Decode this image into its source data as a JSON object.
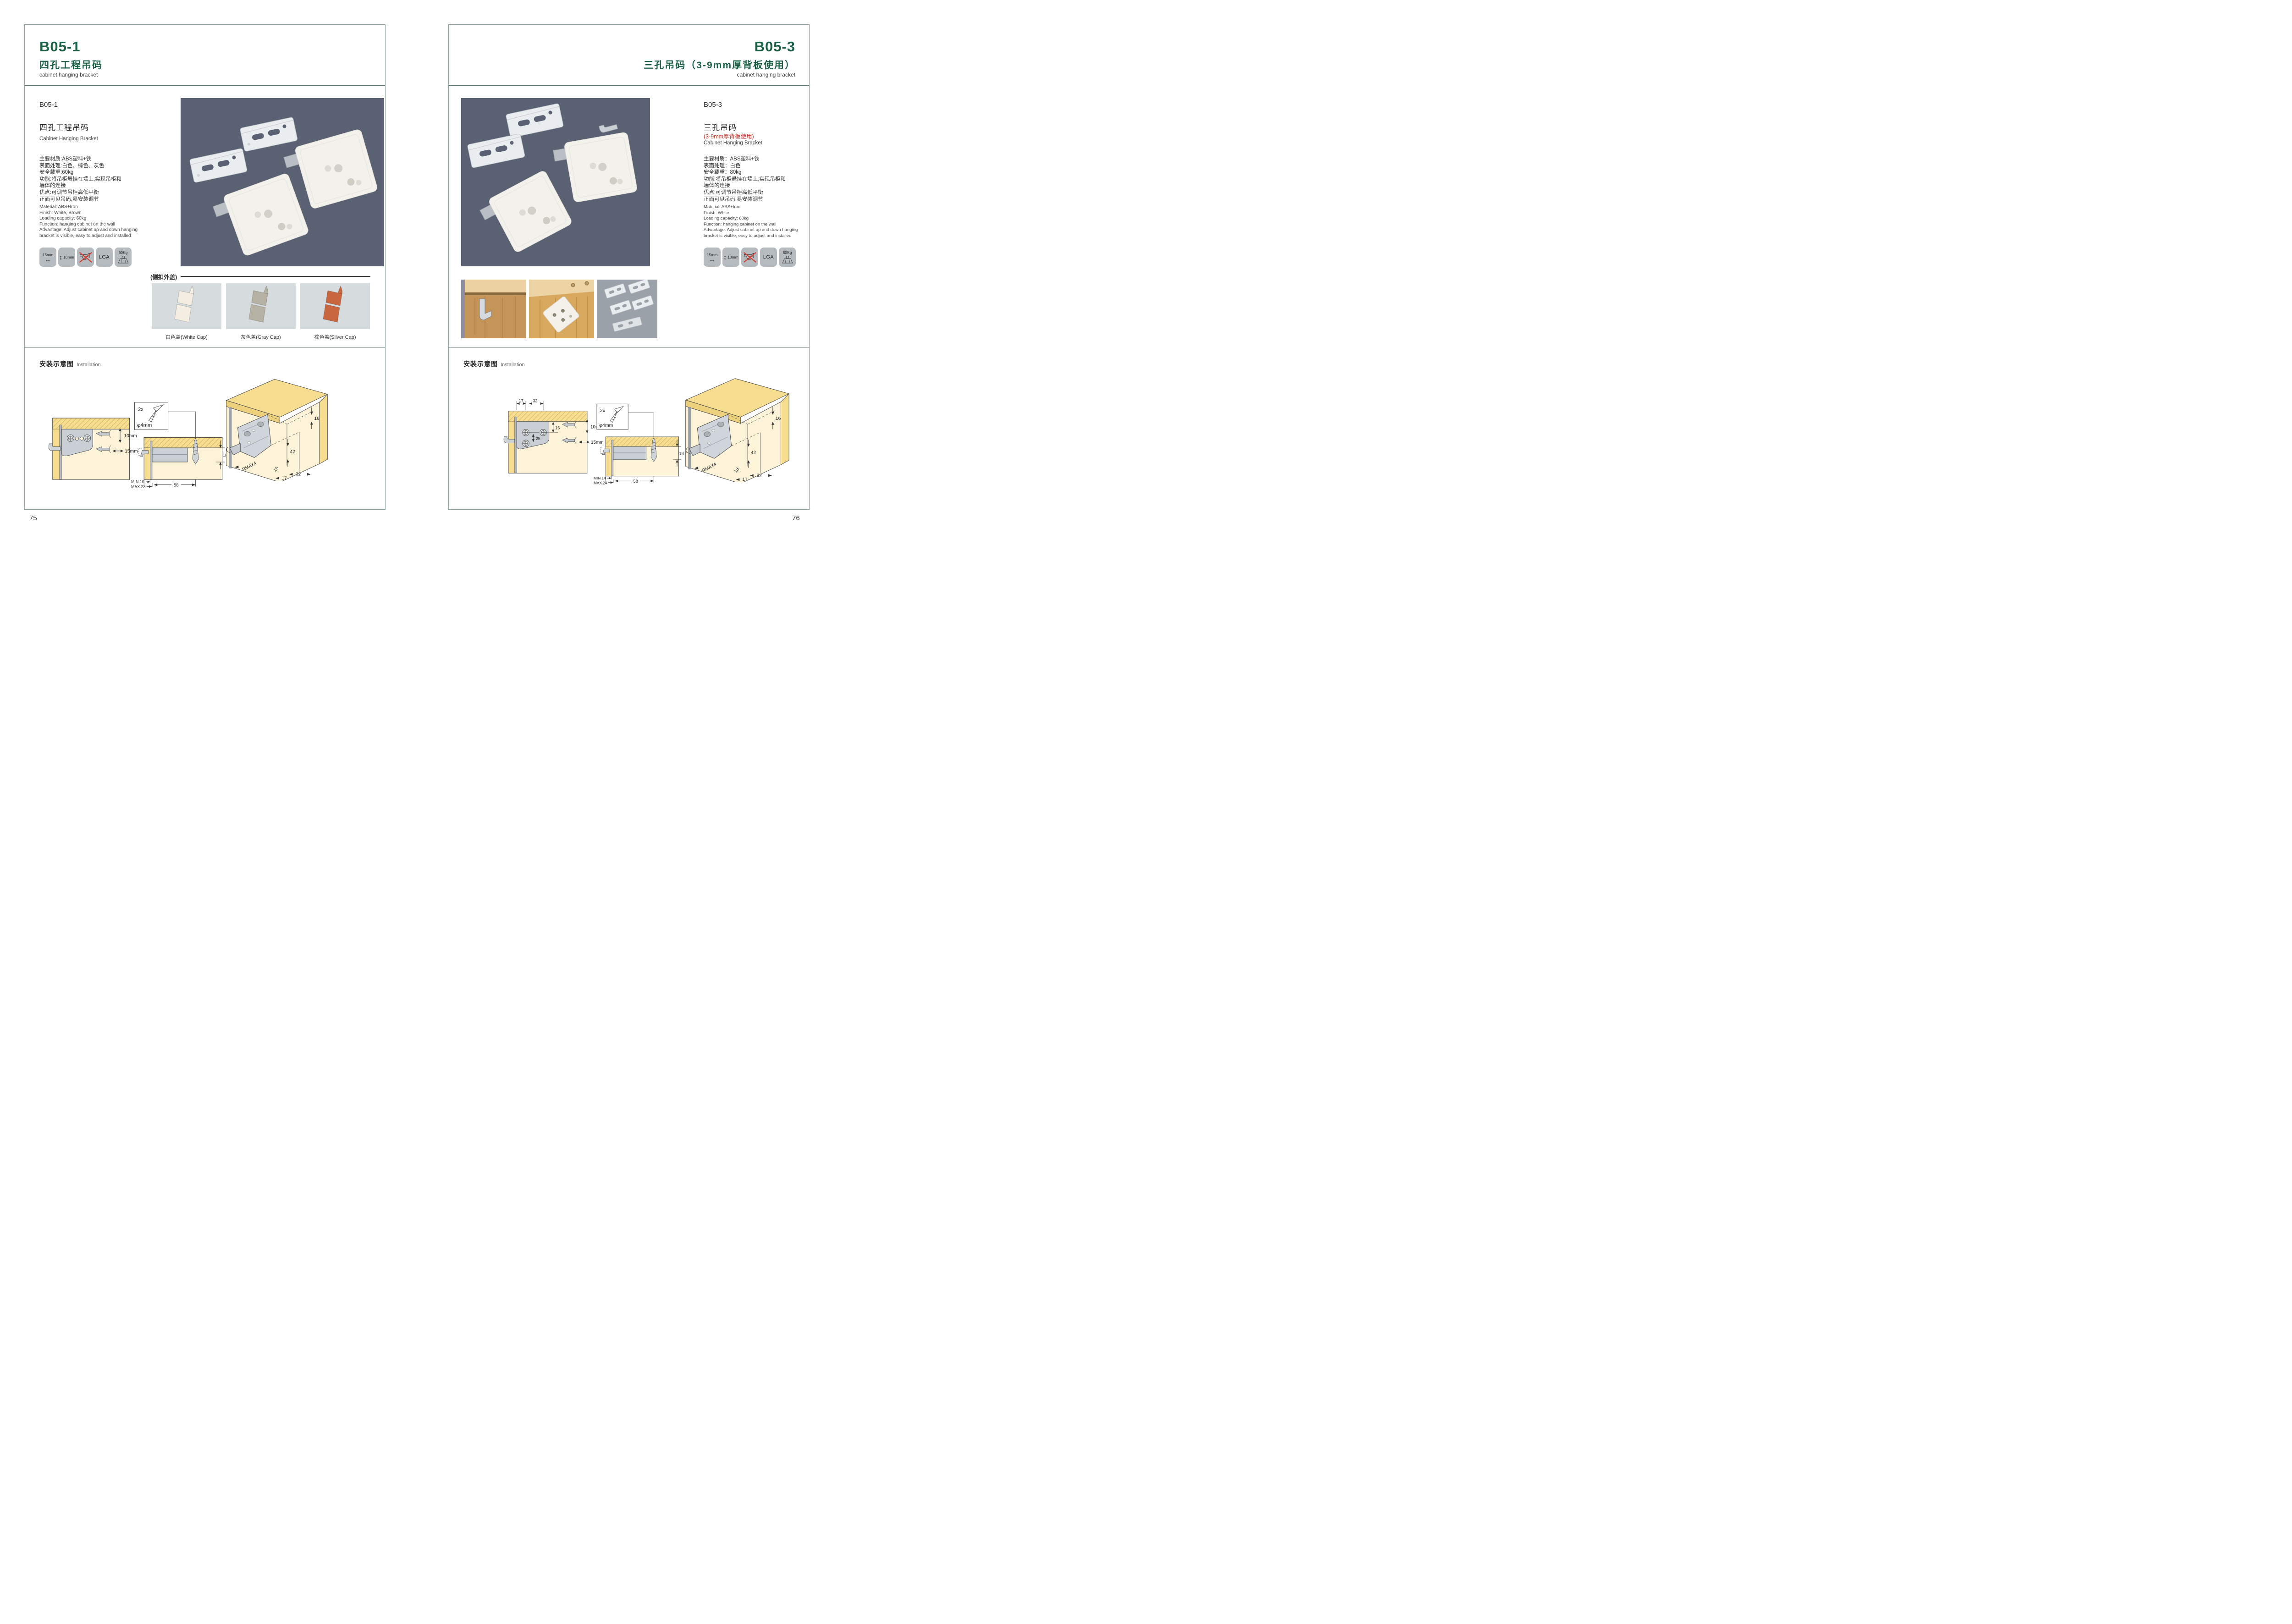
{
  "colors": {
    "brand_green": "#1b6146",
    "note_red": "#c2392e",
    "photo_background": "#5a6173",
    "wood_yellow": "#f6dd8f",
    "icon_tile_gray": "#b6bbbf"
  },
  "left_page": {
    "header": {
      "code": "B05-1",
      "title_cn": "四孔工程吊码",
      "title_en": "cabinet hanging bracket"
    },
    "product": {
      "code": "B05-1",
      "name_cn": "四孔工程吊码",
      "name_en": "Cabinet Hanging Bracket",
      "specs_cn": [
        "主要材质:ABS塑料+铁",
        "表面处理:白色、棕色、灰色",
        "安全载重:60kg",
        "功能:将吊柜悬挂在墙上,实现吊柜和",
        "墙体的连接",
        "优点:可调节吊柜高低平衡",
        "正面可见吊码,易安装调节"
      ],
      "specs_en": [
        "Material: ABS+Iron",
        "Finish: White, Brown",
        "Loading capacity: 60kg",
        "Function: hanging cabinet on the wall",
        "Advantage: Adjust cabinet up and down hanging",
        "bracket is visible, easy to adjust and installed"
      ]
    },
    "feature_icons": {
      "width": "15mm",
      "height": "10mm",
      "lga": "LGA",
      "weight": "60Kg"
    },
    "caps_section": {
      "label": "(侧扣外盖)",
      "caps": [
        {
          "label": "白色盖(White Cap)",
          "color": "#f3eee1"
        },
        {
          "label": "灰色盖(Gray Cap)",
          "color": "#b6b2a3"
        },
        {
          "label": "棕色盖(Silver Cap)",
          "color": "#c8663f"
        }
      ]
    },
    "installation": {
      "title_cn": "安装示意图",
      "title_en": "Installation",
      "diagram1": {
        "depth": "10mm",
        "width": "15mm"
      },
      "diagram2": {
        "screw_qty": "2x",
        "screw_dia": "φ4mm",
        "panel_thickness": "18",
        "min": "MIN.10",
        "max": "MAX.23",
        "offset": "58"
      },
      "diagram3": {
        "top_offset": "16",
        "height": "42",
        "radius": "RMAX4",
        "dim_a": "16",
        "dim_b": "17",
        "dim_c": "32"
      }
    },
    "page_number": "75"
  },
  "right_page": {
    "header": {
      "code": "B05-3",
      "title_cn": "三孔吊码（3-9mm厚背板使用）",
      "title_en": "cabinet hanging bracket"
    },
    "product": {
      "code": "B05-3",
      "name_cn": "三孔吊码",
      "name_note_red": "(3-9mm厚背板使用)",
      "name_en": "Cabinet Hanging Bracket",
      "specs_cn": [
        "主要材质：ABS塑料+铁",
        "表面处理：白色",
        "安全载重：80kg",
        "功能:将吊柜悬挂在墙上,实现吊柜和",
        "墙体的连接",
        "优点:可调节吊柜高低平衡",
        "正面可见吊码,易安装调节"
      ],
      "specs_en": [
        "Material: ABS+Iron",
        "Finish: White",
        "Loading capacity: 80kg",
        "Function: hanging cabinet on the wall",
        "Advantage: Adjust cabinet up and down hanging",
        "bracket is visible, easy to adjust and installed"
      ]
    },
    "feature_icons": {
      "width": "15mm",
      "height": "10mm",
      "lga": "LGA",
      "weight": "80Kg"
    },
    "installation": {
      "title_cn": "安装示意图",
      "title_en": "Installation",
      "diagram1": {
        "hole_a": "17",
        "hole_b": "32",
        "edge": "16",
        "pitch": "25",
        "depth": "10mm",
        "width": "15mm"
      },
      "diagram2": {
        "screw_qty": "2x",
        "screw_dia": "φ4mm",
        "panel_thickness": "18",
        "min": "MIN.14",
        "max": "MAX.24",
        "offset": "58"
      },
      "diagram3": {
        "top_offset": "16",
        "height": "42",
        "radius": "RMAX4",
        "dim_a": "18",
        "dim_b": "17",
        "dim_c": "32"
      }
    },
    "page_number": "76"
  }
}
